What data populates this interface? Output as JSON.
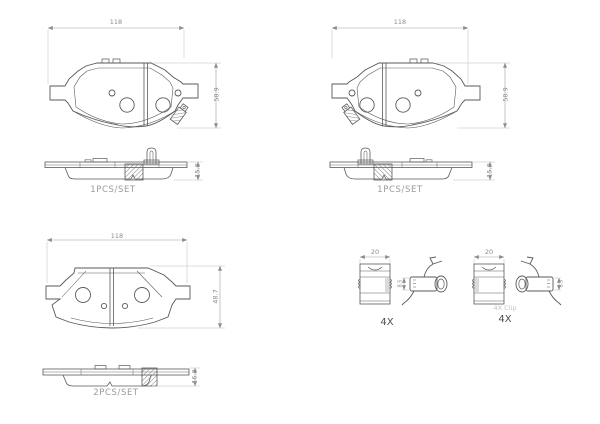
{
  "colors": {
    "background": "#ffffff",
    "drawing_line": "#5a5a5a",
    "dimension_line": "#9f9f9f",
    "dimension_text": "#8c8c8c",
    "label_text": "#9a9a9a",
    "quantity_text": "#4d4d4d",
    "watermark_text": "#c2c2c2"
  },
  "panels": {
    "front_left": {
      "width_dim": "118",
      "height_dim": "58.9"
    },
    "edge_left": {
      "label": "1PCS/SET",
      "thickness_dim": "15.8"
    },
    "front_right": {
      "width_dim": "118",
      "height_dim": "58.9"
    },
    "edge_right": {
      "label": "1PCS/SET",
      "thickness_dim": "15.8"
    },
    "rear": {
      "width_dim": "118",
      "height_dim": "48.7"
    },
    "rear_edge": {
      "label": "2PCS/SET",
      "thickness_dim": "16.8"
    },
    "clips": {
      "left": {
        "width_dim": "20",
        "height_dim": "8.5",
        "quantity": "4X"
      },
      "right": {
        "width_dim": "20",
        "height_dim": "8.5",
        "note": "4X Clip",
        "quantity": "4X"
      }
    }
  }
}
